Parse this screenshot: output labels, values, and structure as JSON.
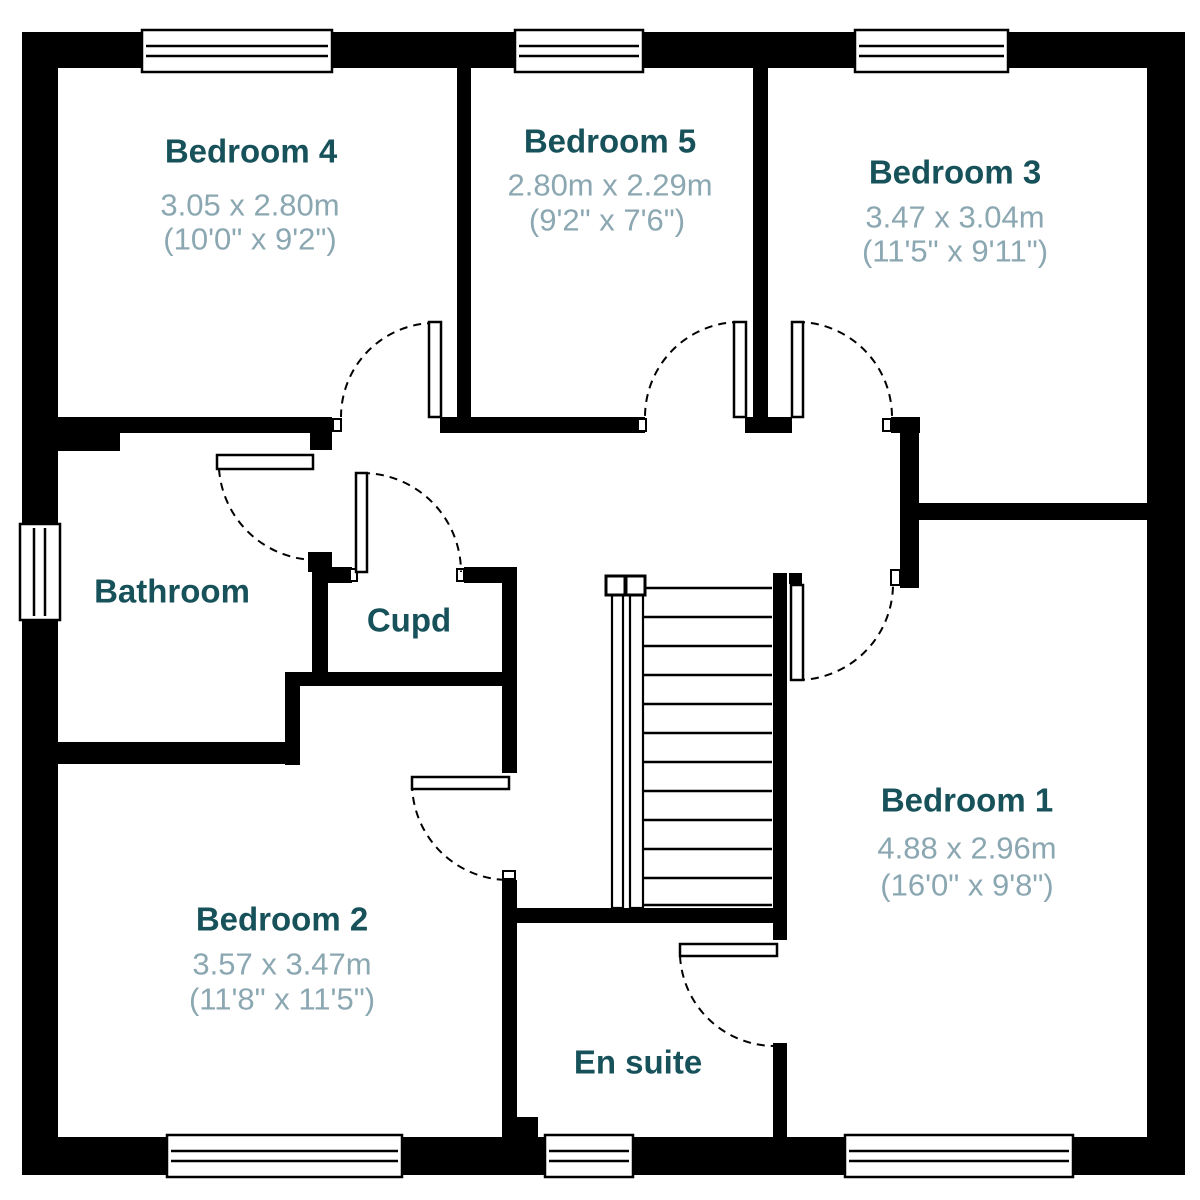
{
  "rooms": {
    "bedroom4": {
      "name": "Bedroom 4",
      "metric": "3.05 x 2.80m",
      "imperial": "(10'0\" x 9'2\")"
    },
    "bedroom5": {
      "name": "Bedroom 5",
      "metric": "2.80m x 2.29m",
      "imperial": "(9'2\" x 7'6\")"
    },
    "bedroom3": {
      "name": "Bedroom 3",
      "metric": "3.47 x 3.04m",
      "imperial": "(11'5\" x 9'11\")"
    },
    "bedroom2": {
      "name": "Bedroom 2",
      "metric": "3.57 x 3.47m",
      "imperial": "(11'8\" x 11'5\")"
    },
    "bedroom1": {
      "name": "Bedroom 1",
      "metric": "4.88 x 2.96m",
      "imperial": "(16'0\" x 9'8\")"
    },
    "bathroom": {
      "name": "Bathroom"
    },
    "cupboard": {
      "name": "Cupd"
    },
    "ensuite": {
      "name": "En suite"
    }
  },
  "colors": {
    "walls": "#000000",
    "background": "#ffffff",
    "room_name": "#17525b",
    "dimensions": "#8ba7b1"
  }
}
